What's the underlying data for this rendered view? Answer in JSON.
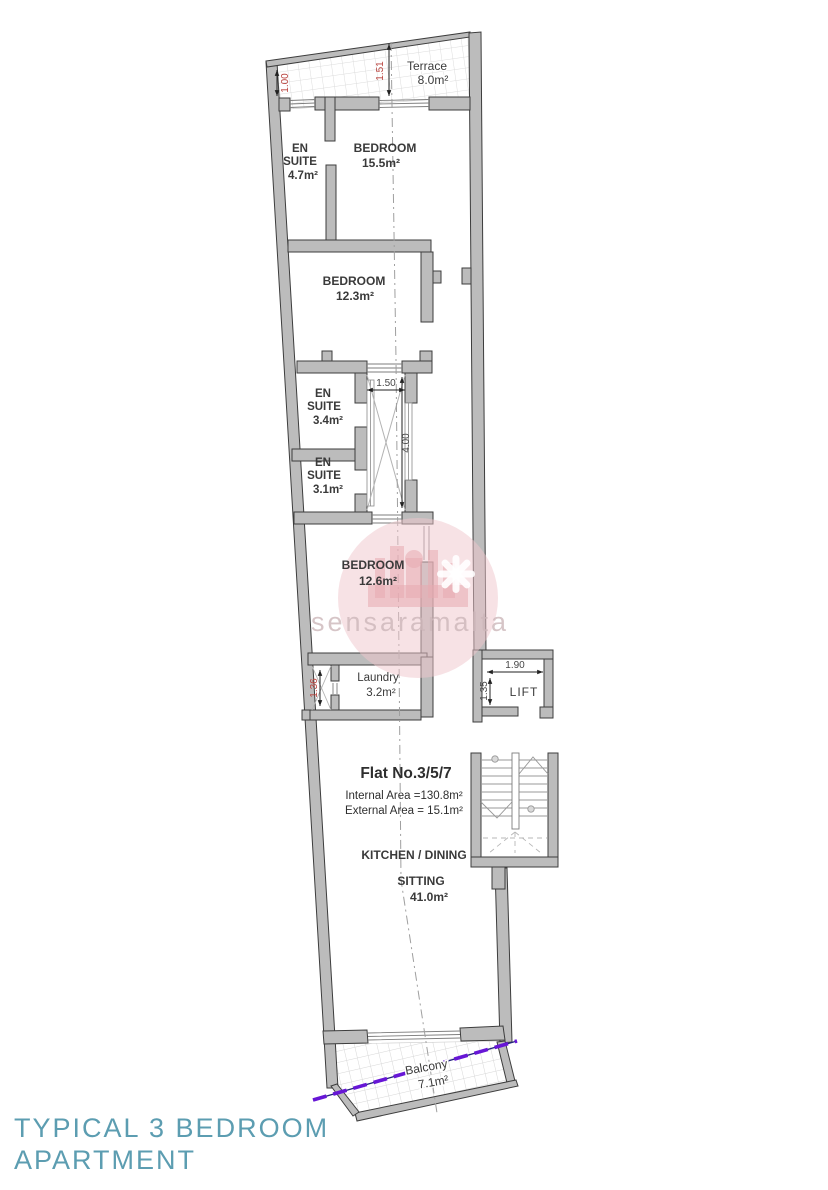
{
  "title": {
    "line1": "TYPICAL 3 BEDROOM",
    "line2": "APARTMENT"
  },
  "watermark": {
    "text": "sensaramalta"
  },
  "plan": {
    "flat": {
      "number": "Flat No.3/5/7",
      "internal": "Internal Area =130.8m²",
      "external": "External Area = 15.1m²"
    },
    "rooms": {
      "terrace": {
        "name": "Terrace",
        "area": "8.0m²"
      },
      "ensuite_top": {
        "l1": "EN",
        "l2": "SUITE",
        "area": "4.7m²"
      },
      "bedroom_top": {
        "name": "BEDROOM",
        "area": "15.5m²"
      },
      "bedroom_mid": {
        "name": "BEDROOM",
        "area": "12.3m²"
      },
      "ensuite_mid": {
        "l1": "EN",
        "l2": "SUITE",
        "area": "3.4m²"
      },
      "ensuite_low": {
        "l1": "EN",
        "l2": "SUITE",
        "area": "3.1m²"
      },
      "bedroom_low": {
        "name": "BEDROOM",
        "area": "12.6m²"
      },
      "laundry": {
        "name": "Laundry",
        "area": "3.2m²"
      },
      "lift": {
        "name": "LIFT"
      },
      "kitchen_dining": {
        "name": "KITCHEN / DINING"
      },
      "sitting": {
        "name": "SITTING",
        "area": "41.0m²"
      },
      "balcony": {
        "name": "Balcony",
        "area": "7.1m²"
      }
    },
    "dimensions": {
      "terrace_left": "1.00",
      "terrace_door": "1.51",
      "shaft_w": "1.50",
      "shaft_h": "4.00",
      "duct": "1.36",
      "lift_w": "1.90",
      "lift_d": "1.35"
    }
  },
  "colors": {
    "title_teal": "#5C9DB1",
    "wall_fill": "#bcbcbc",
    "wall_stroke": "#3d3d3d",
    "dim_red": "#b8413c",
    "dim_gray": "#474747",
    "watermark_pink": "#e9aeb4",
    "purple_line": "#6716d6",
    "hatch_gray": "#dcdcdc"
  }
}
